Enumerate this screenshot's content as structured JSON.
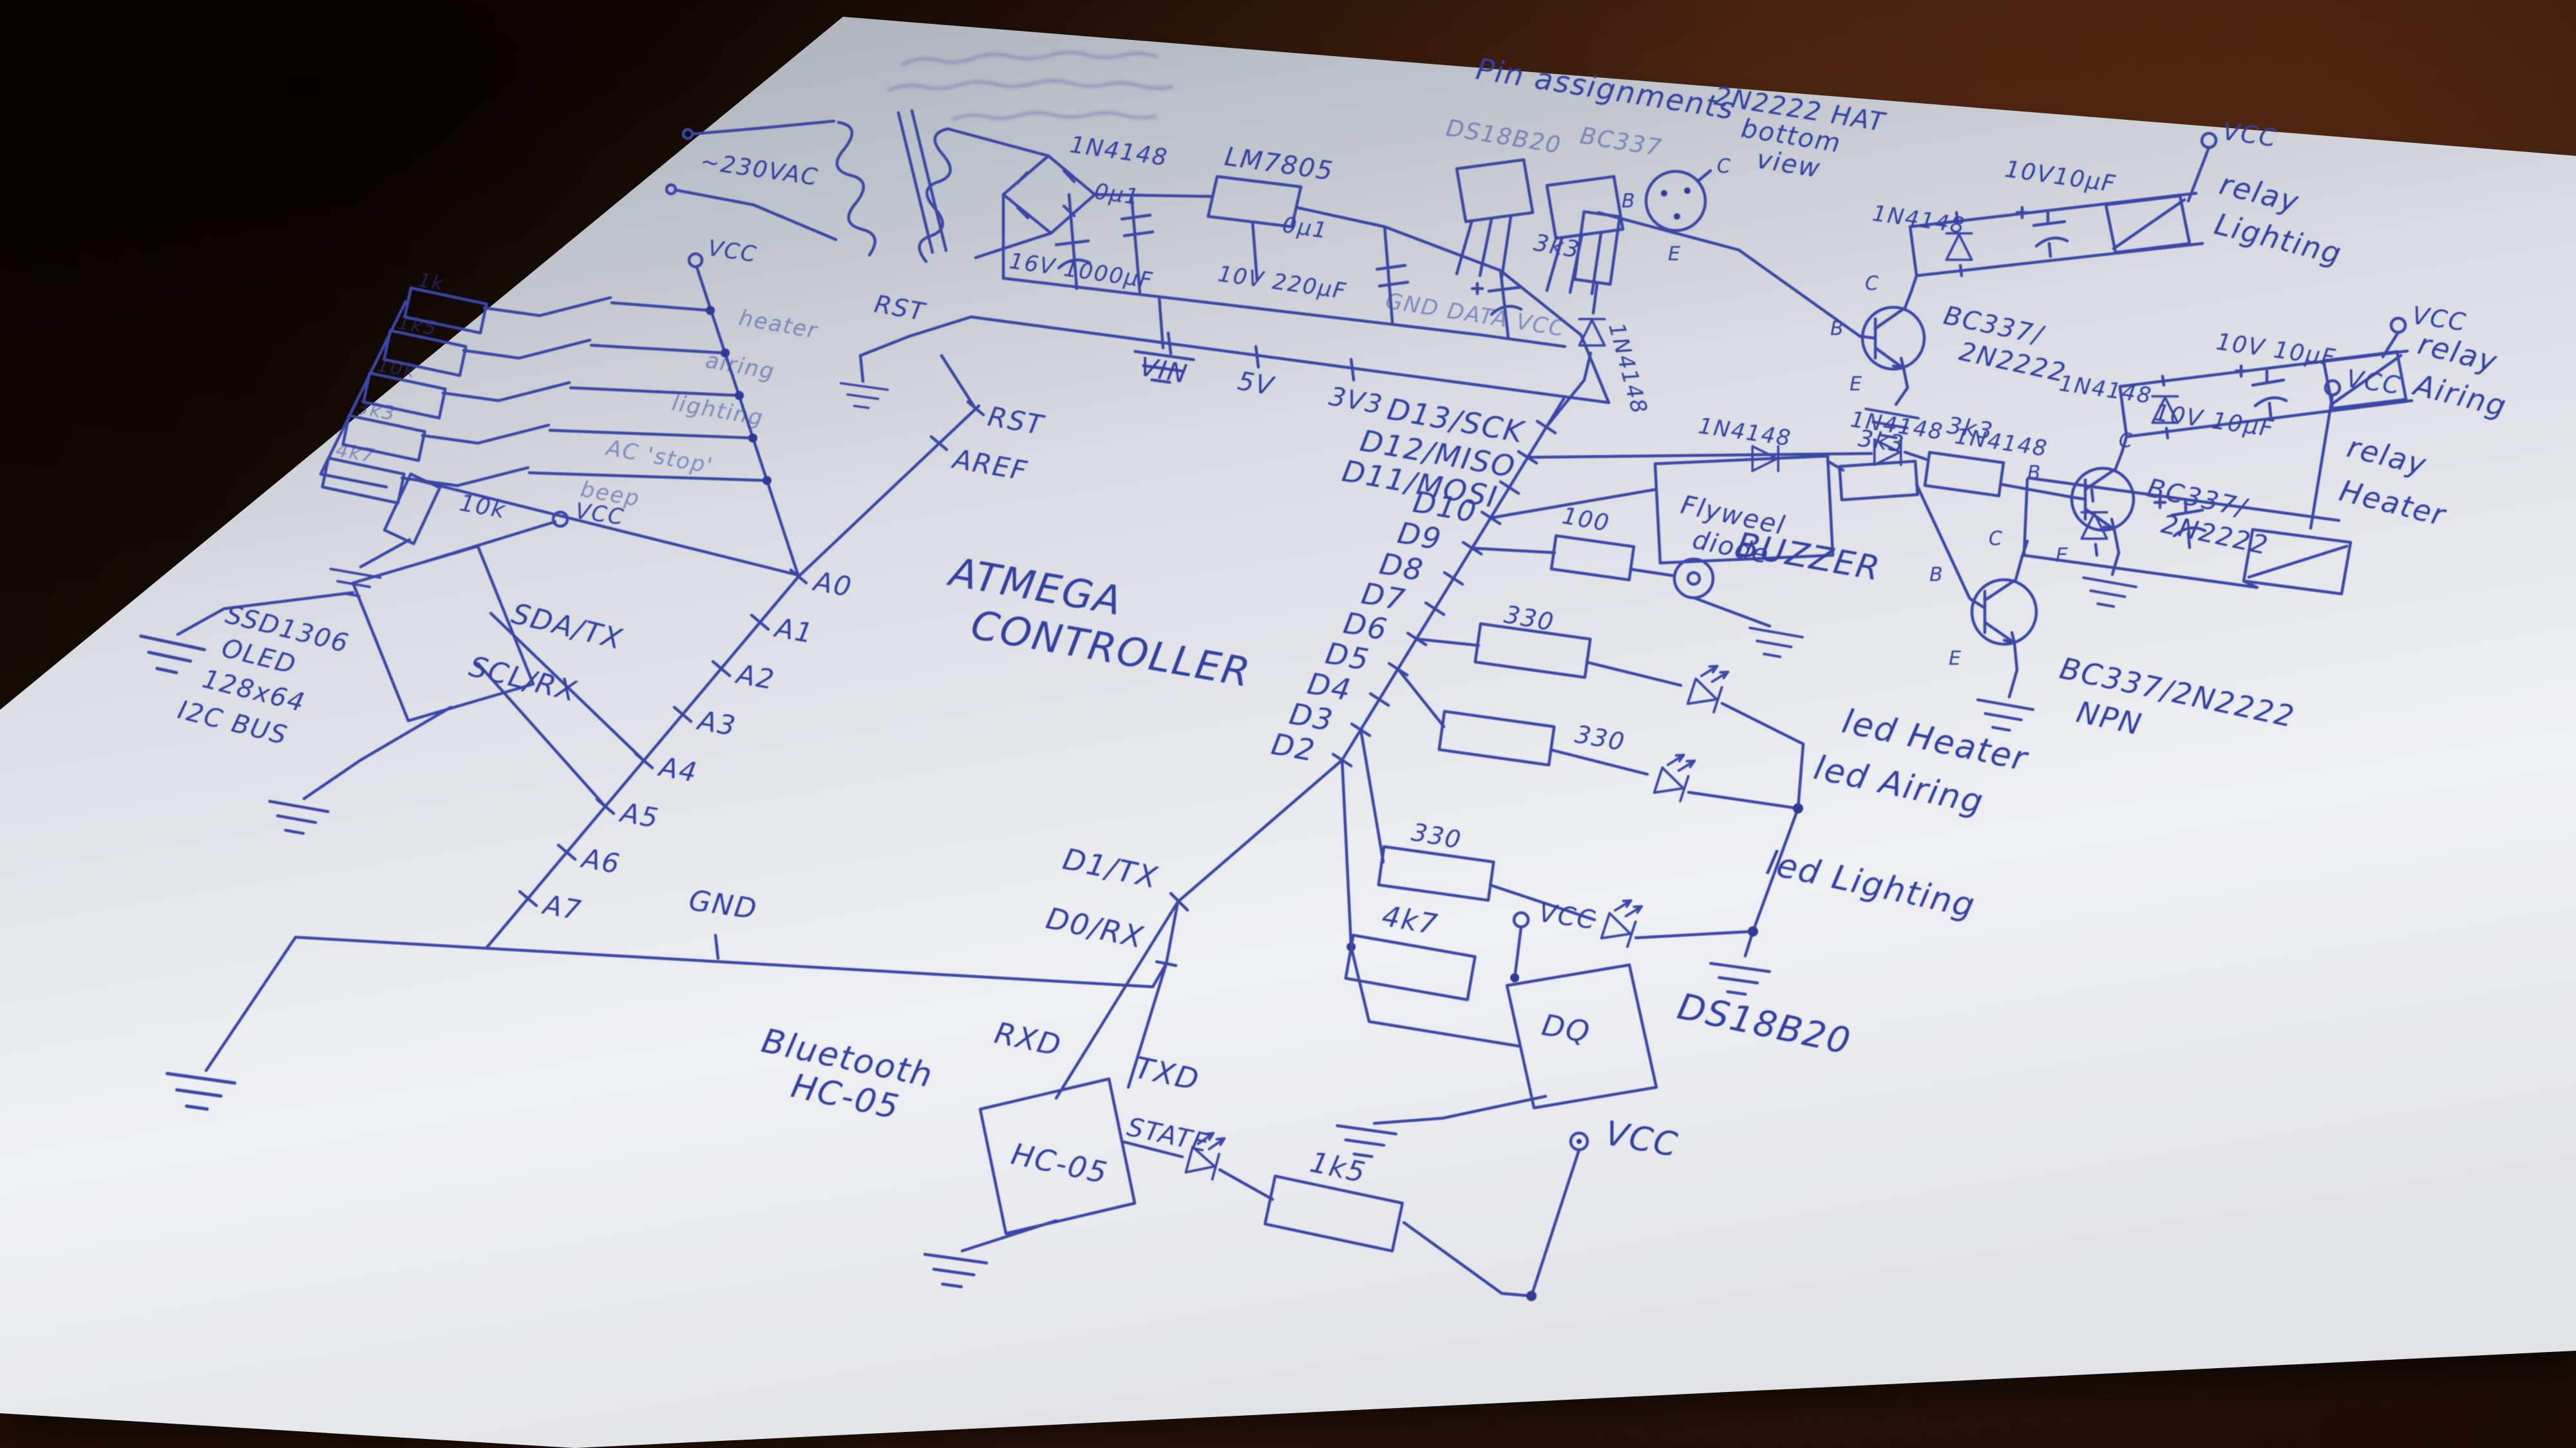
{
  "pin_assignments": {
    "heading": "Pin assignments",
    "package1": "DS18B20",
    "package1_pins": "GND DATA VCC",
    "package2": "BC337",
    "can_b": "B",
    "can_c": "C",
    "can_e": "E",
    "note1": "2N2222 HAT",
    "note2": "bottom",
    "note3": "view"
  },
  "power": {
    "ac": "~230VAC",
    "bridge": "1N4148",
    "regulator": "LM7805",
    "cap1": "0µ1",
    "cap2": "16V 1000µF",
    "cap3": "0µ1",
    "cap4": "10V 220µF",
    "vin": "VIN",
    "v5": "5V",
    "v3": "3V3"
  },
  "controller": {
    "name1": "ATMEGA",
    "name2": "CONTROLLER",
    "reset_switch": "RST",
    "pins": {
      "rst": "RST",
      "aref": "AREF",
      "a0": "A0",
      "a1": "A1",
      "a2": "A2",
      "a3": "A3",
      "a4": "A4",
      "a5": "A5",
      "a6": "A6",
      "a7": "A7",
      "d13": "D13/SCK",
      "d12": "D12/MISO",
      "d11": "D11/MOSI",
      "d10": "D10",
      "d9": "D9",
      "d8": "D8",
      "d7": "D7",
      "d6": "D6",
      "d5": "D5",
      "d4": "D4",
      "d3": "D3",
      "d2": "D2",
      "d1": "D1/TX",
      "d0": "D0/RX",
      "gnd": "GND",
      "sda": "SDA/TX",
      "scl": "SCL/RX"
    }
  },
  "buttons": {
    "values": [
      "1k",
      "1k5",
      "10k",
      "3k3",
      "4k7"
    ],
    "labels": [
      "heater",
      "airing",
      "lighting",
      "AC 'stop'",
      "beep"
    ],
    "vcc": "VCC",
    "pullup": "10k",
    "pullup_vcc": "VCC"
  },
  "oled": {
    "line1": "SSD1306",
    "line2": "OLED",
    "line3": "128x64",
    "line4": "I2C BUS"
  },
  "relays": {
    "lighting": {
      "chain_diode": "1N4148",
      "base_res": "3k3",
      "flyback": "1N4148",
      "cap": "10V10µF",
      "vcc": "VCC",
      "name1": "relay",
      "name2": "Lighting",
      "t1": "BC337/",
      "t2": "2N2222",
      "b": "B",
      "c": "C",
      "e": "E"
    },
    "airing": {
      "chain_diode": "1N4148",
      "base_res": "3k3",
      "flyback": "1N4148",
      "cap": "10V 10µF",
      "vcc": "VCC",
      "name1": "relay",
      "name2": "Airing",
      "t1": "BC337/",
      "t2": "2N2222",
      "b": "B",
      "c": "C",
      "e": "E"
    },
    "heater": {
      "chain_diode": "1N4148",
      "base_res": "3k3",
      "flywheel1": "Flyweel",
      "flywheel2": "diode",
      "flyback": "1N4148",
      "cap": "10V 10µF",
      "vcc": "VCC",
      "name1": "relay",
      "name2": "Heater",
      "t1": "BC337/2N2222",
      "t2": "NPN",
      "b": "B",
      "c": "C",
      "e": "E"
    }
  },
  "buzzer": {
    "res": "100",
    "name": "BUZZER"
  },
  "leds": {
    "r1": "330",
    "r2": "330",
    "r3": "330",
    "l1": "led Heater",
    "l2": "led Airing",
    "l3": "led Lighting"
  },
  "sensor": {
    "pullup": "4k7",
    "vcc": "VCC",
    "pin": "DQ",
    "name": "DS18B20",
    "vcc2": "VCC"
  },
  "bluetooth": {
    "name1": "Bluetooth",
    "name2": "HC-05",
    "module": "HC-05",
    "rxd": "RXD",
    "txd": "TXD",
    "state": "STATE",
    "res": "1k5"
  }
}
